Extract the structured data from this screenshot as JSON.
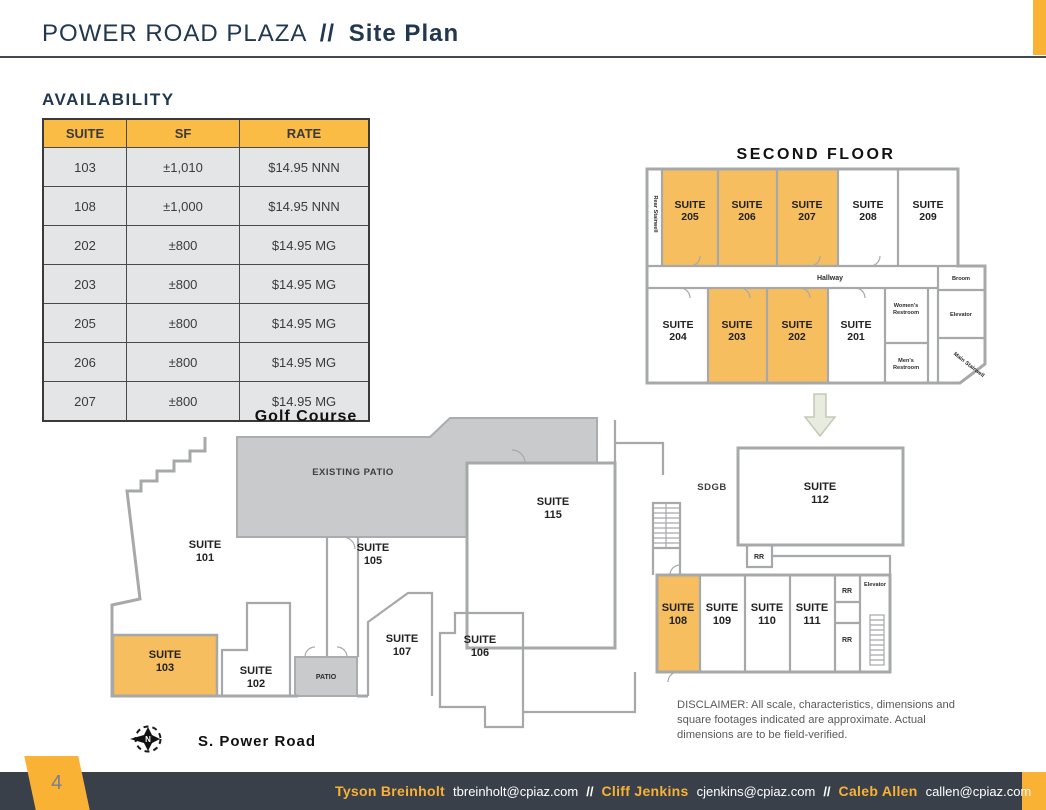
{
  "page": {
    "title_main": "POWER ROAD PLAZA",
    "title_sep": "//",
    "title_sub": "Site Plan",
    "page_number": "4"
  },
  "colors": {
    "accent_yellow": "#F9B234",
    "table_header_yellow": "#FBBC45",
    "suite_highlight_orange": "#F6BE5E",
    "patio_gray": "#C9CACC",
    "wall_gray": "#A7A8AA",
    "navy": "#21384F",
    "footer_bg": "#3A4049"
  },
  "availability": {
    "heading": "AVAILABILITY",
    "headers": [
      "SUITE",
      "SF",
      "RATE"
    ],
    "rows": [
      {
        "suite": "103",
        "sf": "±1,010",
        "rate": "$14.95 NNN"
      },
      {
        "suite": "108",
        "sf": "±1,000",
        "rate": "$14.95 NNN"
      },
      {
        "suite": "202",
        "sf": "±800",
        "rate": "$14.95 MG"
      },
      {
        "suite": "203",
        "sf": "±800",
        "rate": "$14.95 MG"
      },
      {
        "suite": "205",
        "sf": "±800",
        "rate": "$14.95 MG"
      },
      {
        "suite": "206",
        "sf": "±800",
        "rate": "$14.95 MG"
      },
      {
        "suite": "207",
        "sf": "±800",
        "rate": "$14.95 MG"
      }
    ]
  },
  "second_floor": {
    "title": "SECOND FLOOR",
    "suite_word": "SUITE",
    "suites": [
      {
        "num": "205",
        "highlighted": true
      },
      {
        "num": "206",
        "highlighted": true
      },
      {
        "num": "207",
        "highlighted": true
      },
      {
        "num": "208",
        "highlighted": false
      },
      {
        "num": "209",
        "highlighted": false
      },
      {
        "num": "204",
        "highlighted": false
      },
      {
        "num": "203",
        "highlighted": true
      },
      {
        "num": "202",
        "highlighted": true
      },
      {
        "num": "201",
        "highlighted": false
      }
    ],
    "hallway": "Hallway",
    "broom": "Broom",
    "elevator": "Elevator",
    "womens_1": "Women's",
    "womens_2": "Restroom",
    "mens_1": "Men's",
    "mens_2": "Restroom",
    "rear_stairwell": "Rear Stairwell",
    "main_stairwell": "Main Stairwell"
  },
  "site_plan": {
    "golf_course": "Golf Course",
    "existing_patio": "EXISTING PATIO",
    "patio": "PATIO",
    "sdgb": "SDGB",
    "rr": "RR",
    "elevator": "Elevator",
    "power_road": "S. Power Road",
    "compass_n": "N",
    "suite_word": "SUITE",
    "suites": [
      {
        "num": "101",
        "highlighted": false
      },
      {
        "num": "105",
        "highlighted": false
      },
      {
        "num": "115",
        "highlighted": false
      },
      {
        "num": "112",
        "highlighted": false
      },
      {
        "num": "103",
        "highlighted": true
      },
      {
        "num": "102",
        "highlighted": false
      },
      {
        "num": "107",
        "highlighted": false
      },
      {
        "num": "106",
        "highlighted": false
      },
      {
        "num": "108",
        "highlighted": true
      },
      {
        "num": "109",
        "highlighted": false
      },
      {
        "num": "110",
        "highlighted": false
      },
      {
        "num": "111",
        "highlighted": false
      }
    ]
  },
  "disclaimer": {
    "text": "DISCLAIMER: All scale, characteristics, dimensions and square footages indicated are approximate. Actual dimensions are to be field-verified."
  },
  "footer": {
    "sep": "//",
    "contacts": [
      {
        "name": "Tyson Breinholt",
        "email": "tbreinholt@cpiaz.com"
      },
      {
        "name": "Cliff Jenkins",
        "email": "cjenkins@cpiaz.com"
      },
      {
        "name": "Caleb Allen",
        "email": "callen@cpiaz.com"
      }
    ]
  }
}
